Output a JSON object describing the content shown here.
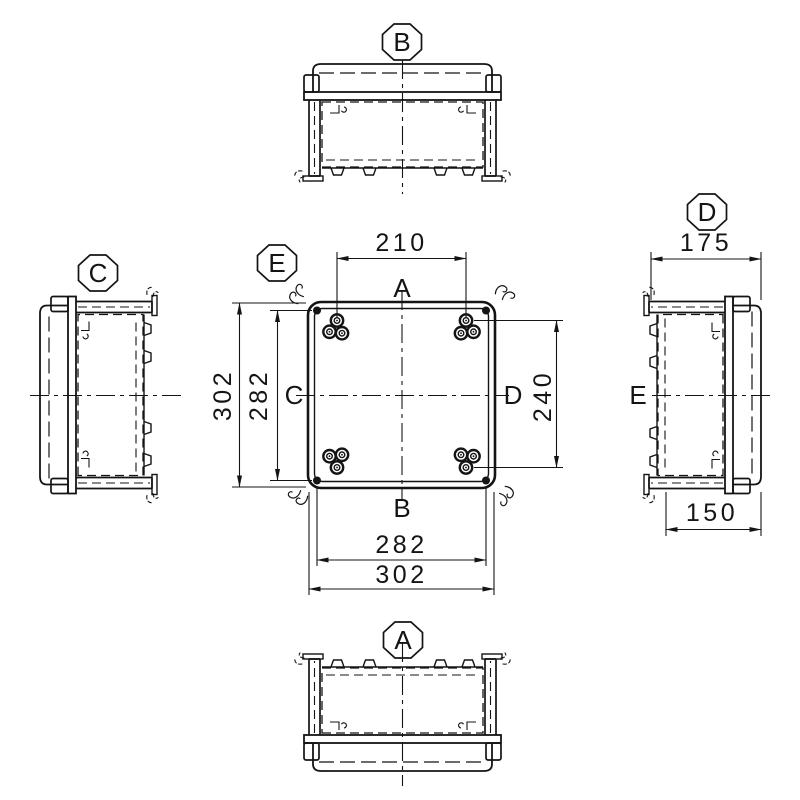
{
  "colors": {
    "line": "#141414",
    "background": "#ffffff"
  },
  "views": {
    "top": {
      "label": "B"
    },
    "bottom": {
      "label": "A"
    },
    "left": {
      "label": "C"
    },
    "right": {
      "label": "D",
      "axis_label": "E",
      "dims": {
        "overall_depth": "175",
        "body_depth": "150"
      }
    },
    "plan": {
      "label": "E",
      "side_labels": {
        "top": "A",
        "bottom": "B",
        "left": "C",
        "right": "D"
      },
      "dims": {
        "hole_pitch_horizontal": "210",
        "overall_height": "302",
        "screw_pitch_vertical": "282",
        "hole_pitch_vertical": "240",
        "screw_pitch_horizontal": "282",
        "overall_width": "302"
      }
    }
  }
}
